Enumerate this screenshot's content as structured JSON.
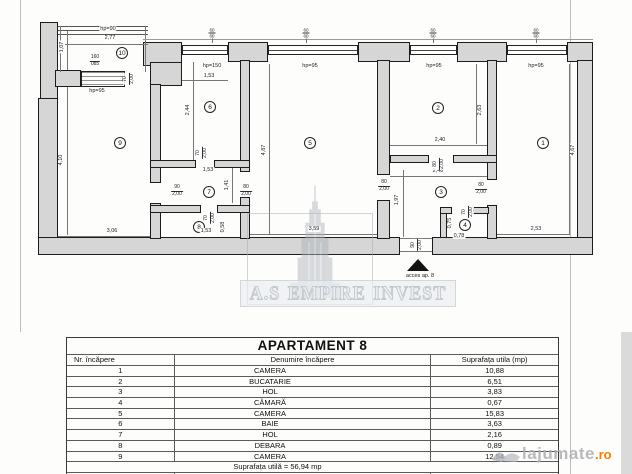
{
  "colors": {
    "wall_fill": "#d6d6d6",
    "badge_orange": "#ff7a00",
    "watermark_gray": "#c2c8ce"
  },
  "watermark": {
    "text": "A.S EMPIRE INVEST"
  },
  "badge": {
    "text": "lajumate",
    "tld": ".ro"
  },
  "plan": {
    "access_label": "acces ap. 8",
    "rooms": [
      {
        "n": "1",
        "x": 543,
        "y": 143
      },
      {
        "n": "2",
        "x": 438,
        "y": 108
      },
      {
        "n": "3",
        "x": 441,
        "y": 192
      },
      {
        "n": "4",
        "x": 465,
        "y": 225
      },
      {
        "n": "5",
        "x": 310,
        "y": 143
      },
      {
        "n": "6",
        "x": 210,
        "y": 107
      },
      {
        "n": "7",
        "x": 209,
        "y": 192
      },
      {
        "n": "8",
        "x": 199,
        "y": 227
      },
      {
        "n": "9",
        "x": 120,
        "y": 143
      },
      {
        "n": "10",
        "x": 122,
        "y": 53
      }
    ],
    "dims": [
      {
        "t": "hp=90",
        "x": 108,
        "y": 29
      },
      {
        "t": "2,77",
        "x": 110,
        "y": 38
      },
      {
        "t": "1,07",
        "x": 62,
        "y": 47,
        "r": 1
      },
      {
        "t": "hp=95",
        "x": 97,
        "y": 91
      },
      {
        "t": "4,10",
        "x": 61,
        "y": 160,
        "r": 1
      },
      {
        "t": "3,06",
        "x": 112,
        "y": 231
      },
      {
        "t": "hp=150",
        "x": 212,
        "y": 66
      },
      {
        "t": "1,53",
        "x": 209,
        "y": 76
      },
      {
        "t": "2,44",
        "x": 188,
        "y": 110,
        "r": 1
      },
      {
        "t": "hp=95",
        "x": 310,
        "y": 66
      },
      {
        "t": "3,59",
        "x": 314,
        "y": 229
      },
      {
        "t": "4,87",
        "x": 264,
        "y": 150,
        "r": 1
      },
      {
        "t": "hp=95",
        "x": 434,
        "y": 66
      },
      {
        "t": "2,40",
        "x": 440,
        "y": 140
      },
      {
        "t": "2,63",
        "x": 480,
        "y": 110,
        "r": 1
      },
      {
        "t": "2,48",
        "x": 438,
        "y": 171
      },
      {
        "t": "1,97",
        "x": 397,
        "y": 200,
        "r": 1
      },
      {
        "t": "hp=95",
        "x": 536,
        "y": 66
      },
      {
        "t": "2,53",
        "x": 536,
        "y": 229
      },
      {
        "t": "4,67",
        "x": 573,
        "y": 150,
        "r": 1
      },
      {
        "t": "1,41",
        "x": 227,
        "y": 185,
        "r": 1
      },
      {
        "t": "1,53",
        "x": 208,
        "y": 170
      },
      {
        "t": "1,53",
        "x": 206,
        "y": 231
      },
      {
        "t": "0,58",
        "x": 223,
        "y": 227,
        "r": 1
      },
      {
        "t": "0,75",
        "x": 450,
        "y": 223,
        "r": 1
      },
      {
        "t": "0,78",
        "x": 459,
        "y": 236
      }
    ],
    "fracs": [
      {
        "a": "160",
        "b": "085",
        "x": 95,
        "y": 61
      },
      {
        "a": "70",
        "b": "2,00",
        "x": 129,
        "y": 79,
        "r": 1
      },
      {
        "a": "90",
        "b": "2,00",
        "x": 177,
        "y": 191
      },
      {
        "a": "80",
        "b": "2,00",
        "x": 246,
        "y": 191
      },
      {
        "a": "70",
        "b": "2,00",
        "x": 202,
        "y": 153,
        "r": 1
      },
      {
        "a": "70",
        "b": "2,00",
        "x": 210,
        "y": 218,
        "r": 1
      },
      {
        "a": "80",
        "b": "2,00",
        "x": 384,
        "y": 186
      },
      {
        "a": "80",
        "b": "2,00",
        "x": 481,
        "y": 189
      },
      {
        "a": "80",
        "b": "2,00",
        "x": 439,
        "y": 164,
        "r": 1
      },
      {
        "a": "70",
        "b": "2,00",
        "x": 468,
        "y": 212,
        "r": 1
      },
      {
        "a": "90",
        "b": "2,00",
        "x": 417,
        "y": 245,
        "r": 1
      },
      {
        "a": "60",
        "b": "60",
        "x": 212,
        "y": 33,
        "s": 1
      },
      {
        "a": "60",
        "b": "60",
        "x": 306,
        "y": 33,
        "s": 1
      },
      {
        "a": "60",
        "b": "60",
        "x": 433,
        "y": 33,
        "s": 1
      },
      {
        "a": "60",
        "b": "60",
        "x": 536,
        "y": 33,
        "s": 1
      }
    ]
  },
  "table": {
    "title": "APARTAMENT 8",
    "headers": [
      "Nr. încăpere",
      "Denumire încăpere",
      "Suprafața utila (mp)"
    ],
    "rows": [
      [
        "1",
        "CAMERA",
        "10,88"
      ],
      [
        "2",
        "BUCATARIE",
        "6,51"
      ],
      [
        "3",
        "HOL",
        "3,83"
      ],
      [
        "4",
        "CĂMARĂ",
        "0,67"
      ],
      [
        "5",
        "CAMERA",
        "15,83"
      ],
      [
        "6",
        "BAIE",
        "3,63"
      ],
      [
        "7",
        "HOL",
        "2,16"
      ],
      [
        "8",
        "DEBARA",
        "0,89"
      ],
      [
        "9",
        "CAMERA",
        "12,54"
      ]
    ],
    "subtotal_label": "Suprafața utilă = 56,94 mp",
    "balcony_row": [
      "10",
      "BALCON",
      "2,96"
    ],
    "total_label": "Suprafața totală = 59,90 mp"
  }
}
